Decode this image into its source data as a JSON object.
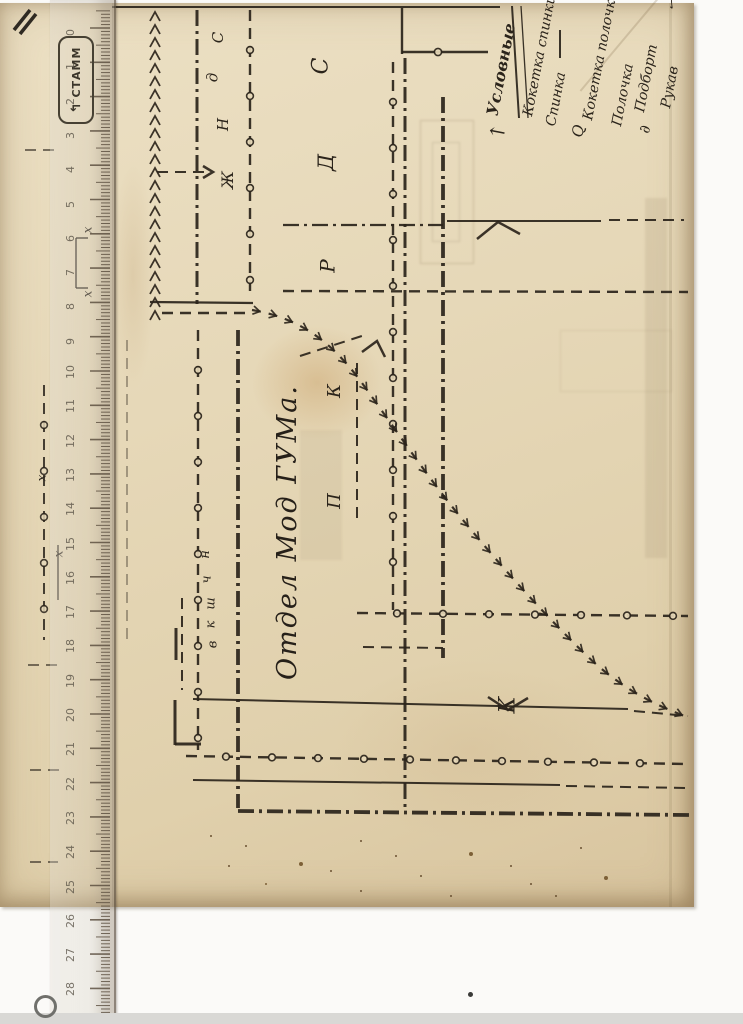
{
  "document": {
    "center_text": "Отдел Мод ГУМа.",
    "legend": {
      "heading": "Условные",
      "items": [
        {
          "symbol": "↑",
          "label": "Кокетка спинки"
        },
        {
          "symbol": "",
          "label": "Спинка"
        },
        {
          "symbol": "Q",
          "label": "Кокетка полочки"
        },
        {
          "symbol": "",
          "label": "Полочка"
        },
        {
          "symbol": "∂",
          "label": "Подборт"
        },
        {
          "symbol": "",
          "label": "Рукав"
        }
      ],
      "checkmark": "✓"
    },
    "ruler": {
      "brand": "СТАММ",
      "numbers_min": 0,
      "numbers_max": 29
    },
    "piece_letters": [
      {
        "t": "С",
        "x": 213,
        "y": 30,
        "s": 15
      },
      {
        "t": "д",
        "x": 208,
        "y": 70,
        "s": 15
      },
      {
        "t": "Н",
        "x": 217,
        "y": 117,
        "s": 15
      },
      {
        "t": "Ж",
        "x": 219,
        "y": 172,
        "s": 16
      },
      {
        "t": "С",
        "x": 313,
        "y": 55,
        "s": 22
      },
      {
        "t": "Д",
        "x": 318,
        "y": 152,
        "s": 21
      },
      {
        "t": "Р",
        "x": 321,
        "y": 256,
        "s": 20
      },
      {
        "t": "К",
        "x": 328,
        "y": 382,
        "s": 18
      },
      {
        "t": "П",
        "x": 327,
        "y": 492,
        "s": 18
      },
      {
        "t": "н",
        "x": 201,
        "y": 548,
        "s": 13
      },
      {
        "t": "ч",
        "x": 203,
        "y": 573,
        "s": 13
      },
      {
        "t": "ш",
        "x": 205,
        "y": 597,
        "s": 13
      },
      {
        "t": "к",
        "x": 207,
        "y": 618,
        "s": 13
      },
      {
        "t": "в",
        "x": 209,
        "y": 638,
        "s": 13
      },
      {
        "t": "К",
        "x": 500,
        "y": 694,
        "s": 22
      },
      {
        "t": "х",
        "x": 84,
        "y": 224,
        "s": 12
      },
      {
        "t": "х",
        "x": 84,
        "y": 288,
        "s": 12
      },
      {
        "t": "х",
        "x": 38,
        "y": 472,
        "s": 12
      },
      {
        "t": "х",
        "x": 55,
        "y": 548,
        "s": 12
      }
    ],
    "pattern": {
      "lines": [
        [
          "solid",
          112,
          7,
          500,
          7,
          2
        ],
        [
          "zigzag",
          155,
          12,
          155,
          314,
          2
        ],
        [
          "dashdot",
          197,
          10,
          197,
          304,
          3
        ],
        [
          "dashcircle",
          250,
          10,
          250,
          298,
          2.4
        ],
        [
          "dash",
          157,
          172,
          208,
          172,
          2
        ],
        [
          "solid",
          402,
          8,
          402,
          54,
          2.4
        ],
        [
          "solid",
          402,
          52,
          488,
          52,
          2.4
        ],
        [
          "circle",
          438,
          52,
          0,
          0,
          1.6
        ],
        [
          "dashcircle",
          393,
          62,
          393,
          610,
          2.4
        ],
        [
          "dashdot",
          405,
          58,
          405,
          810,
          3
        ],
        [
          "dashdot",
          443,
          97,
          443,
          658,
          3.8
        ],
        [
          "solid",
          560,
          30,
          560,
          58,
          2
        ],
        [
          "dashdot",
          283,
          225,
          443,
          225,
          2.2
        ],
        [
          "solid",
          447,
          221,
          601,
          221,
          2
        ],
        [
          "dash",
          609,
          220,
          684,
          220,
          2
        ],
        [
          "dash",
          283,
          291,
          688,
          292,
          2.4
        ],
        [
          "solid",
          150,
          302,
          253,
          303,
          2.2
        ],
        [
          "dash",
          162,
          313,
          250,
          313,
          2.4
        ],
        [
          "dashcircle",
          198,
          330,
          198,
          750,
          2.4
        ],
        [
          "dashdot",
          238,
          330,
          238,
          808,
          3.8
        ],
        [
          "dash",
          357,
          363,
          357,
          518,
          2
        ],
        [
          "dash",
          182,
          598,
          182,
          690,
          2
        ],
        [
          "solid",
          176,
          628,
          176,
          660,
          3
        ],
        [
          "solid",
          175,
          700,
          175,
          745,
          3
        ],
        [
          "solid",
          175,
          744,
          201,
          744,
          3
        ],
        [
          "dash",
          300,
          356,
          368,
          334,
          2
        ],
        [
          "dash",
          363,
          647,
          443,
          648,
          2
        ],
        [
          "dashcircle",
          357,
          613,
          688,
          616,
          2.4
        ],
        [
          "solid",
          193,
          699,
          628,
          709,
          2
        ],
        [
          "dash",
          634,
          711,
          688,
          716,
          2
        ],
        [
          "dashcircle",
          186,
          756,
          688,
          764,
          2.4
        ],
        [
          "solid",
          193,
          780,
          560,
          785,
          2
        ],
        [
          "dash",
          566,
          786,
          688,
          788,
          2
        ],
        [
          "dashdot",
          238,
          811,
          690,
          815,
          3.8
        ],
        [
          "dashcircle",
          44,
          385,
          44,
          640,
          2,
          0.85
        ],
        [
          "dash",
          25,
          150,
          55,
          150,
          1.6,
          0.8
        ],
        [
          "solid",
          76,
          238,
          76,
          288,
          1.6,
          0.8
        ],
        [
          "solid",
          76,
          238,
          88,
          238,
          1.6,
          0.8
        ],
        [
          "solid",
          76,
          288,
          88,
          288,
          1.6,
          0.8
        ],
        [
          "dash",
          28,
          665,
          58,
          665,
          1.6,
          0.8
        ],
        [
          "dash",
          30,
          770,
          60,
          770,
          1.6,
          0.8
        ],
        [
          "dash",
          30,
          862,
          58,
          862,
          1.6,
          0.8
        ],
        [
          "solid",
          58,
          545,
          58,
          600,
          1.6,
          0.8
        ],
        [
          "solid",
          512,
          6,
          519,
          118,
          2
        ],
        [
          "solid",
          521,
          6,
          528,
          118,
          1.3
        ],
        [
          "dash",
          127,
          340,
          127,
          640,
          1.6,
          0.45
        ]
      ],
      "notches": [
        [
          477,
          239,
          498,
          222,
          520,
          234
        ],
        [
          488,
          697,
          508,
          710,
          528,
          698
        ],
        [
          362,
          352,
          377,
          341,
          385,
          357
        ],
        [
          203,
          166,
          213,
          172,
          203,
          178
        ]
      ],
      "curve_path": "M252,310 C300,318 332,342 362,383 C396,430 424,472 458,514 C498,563 540,610 584,653 C622,690 656,705 687,717"
    }
  },
  "colors": {
    "ink": "#2b241b",
    "paper": "#e6d8b8",
    "stain": "#8a4a22"
  }
}
